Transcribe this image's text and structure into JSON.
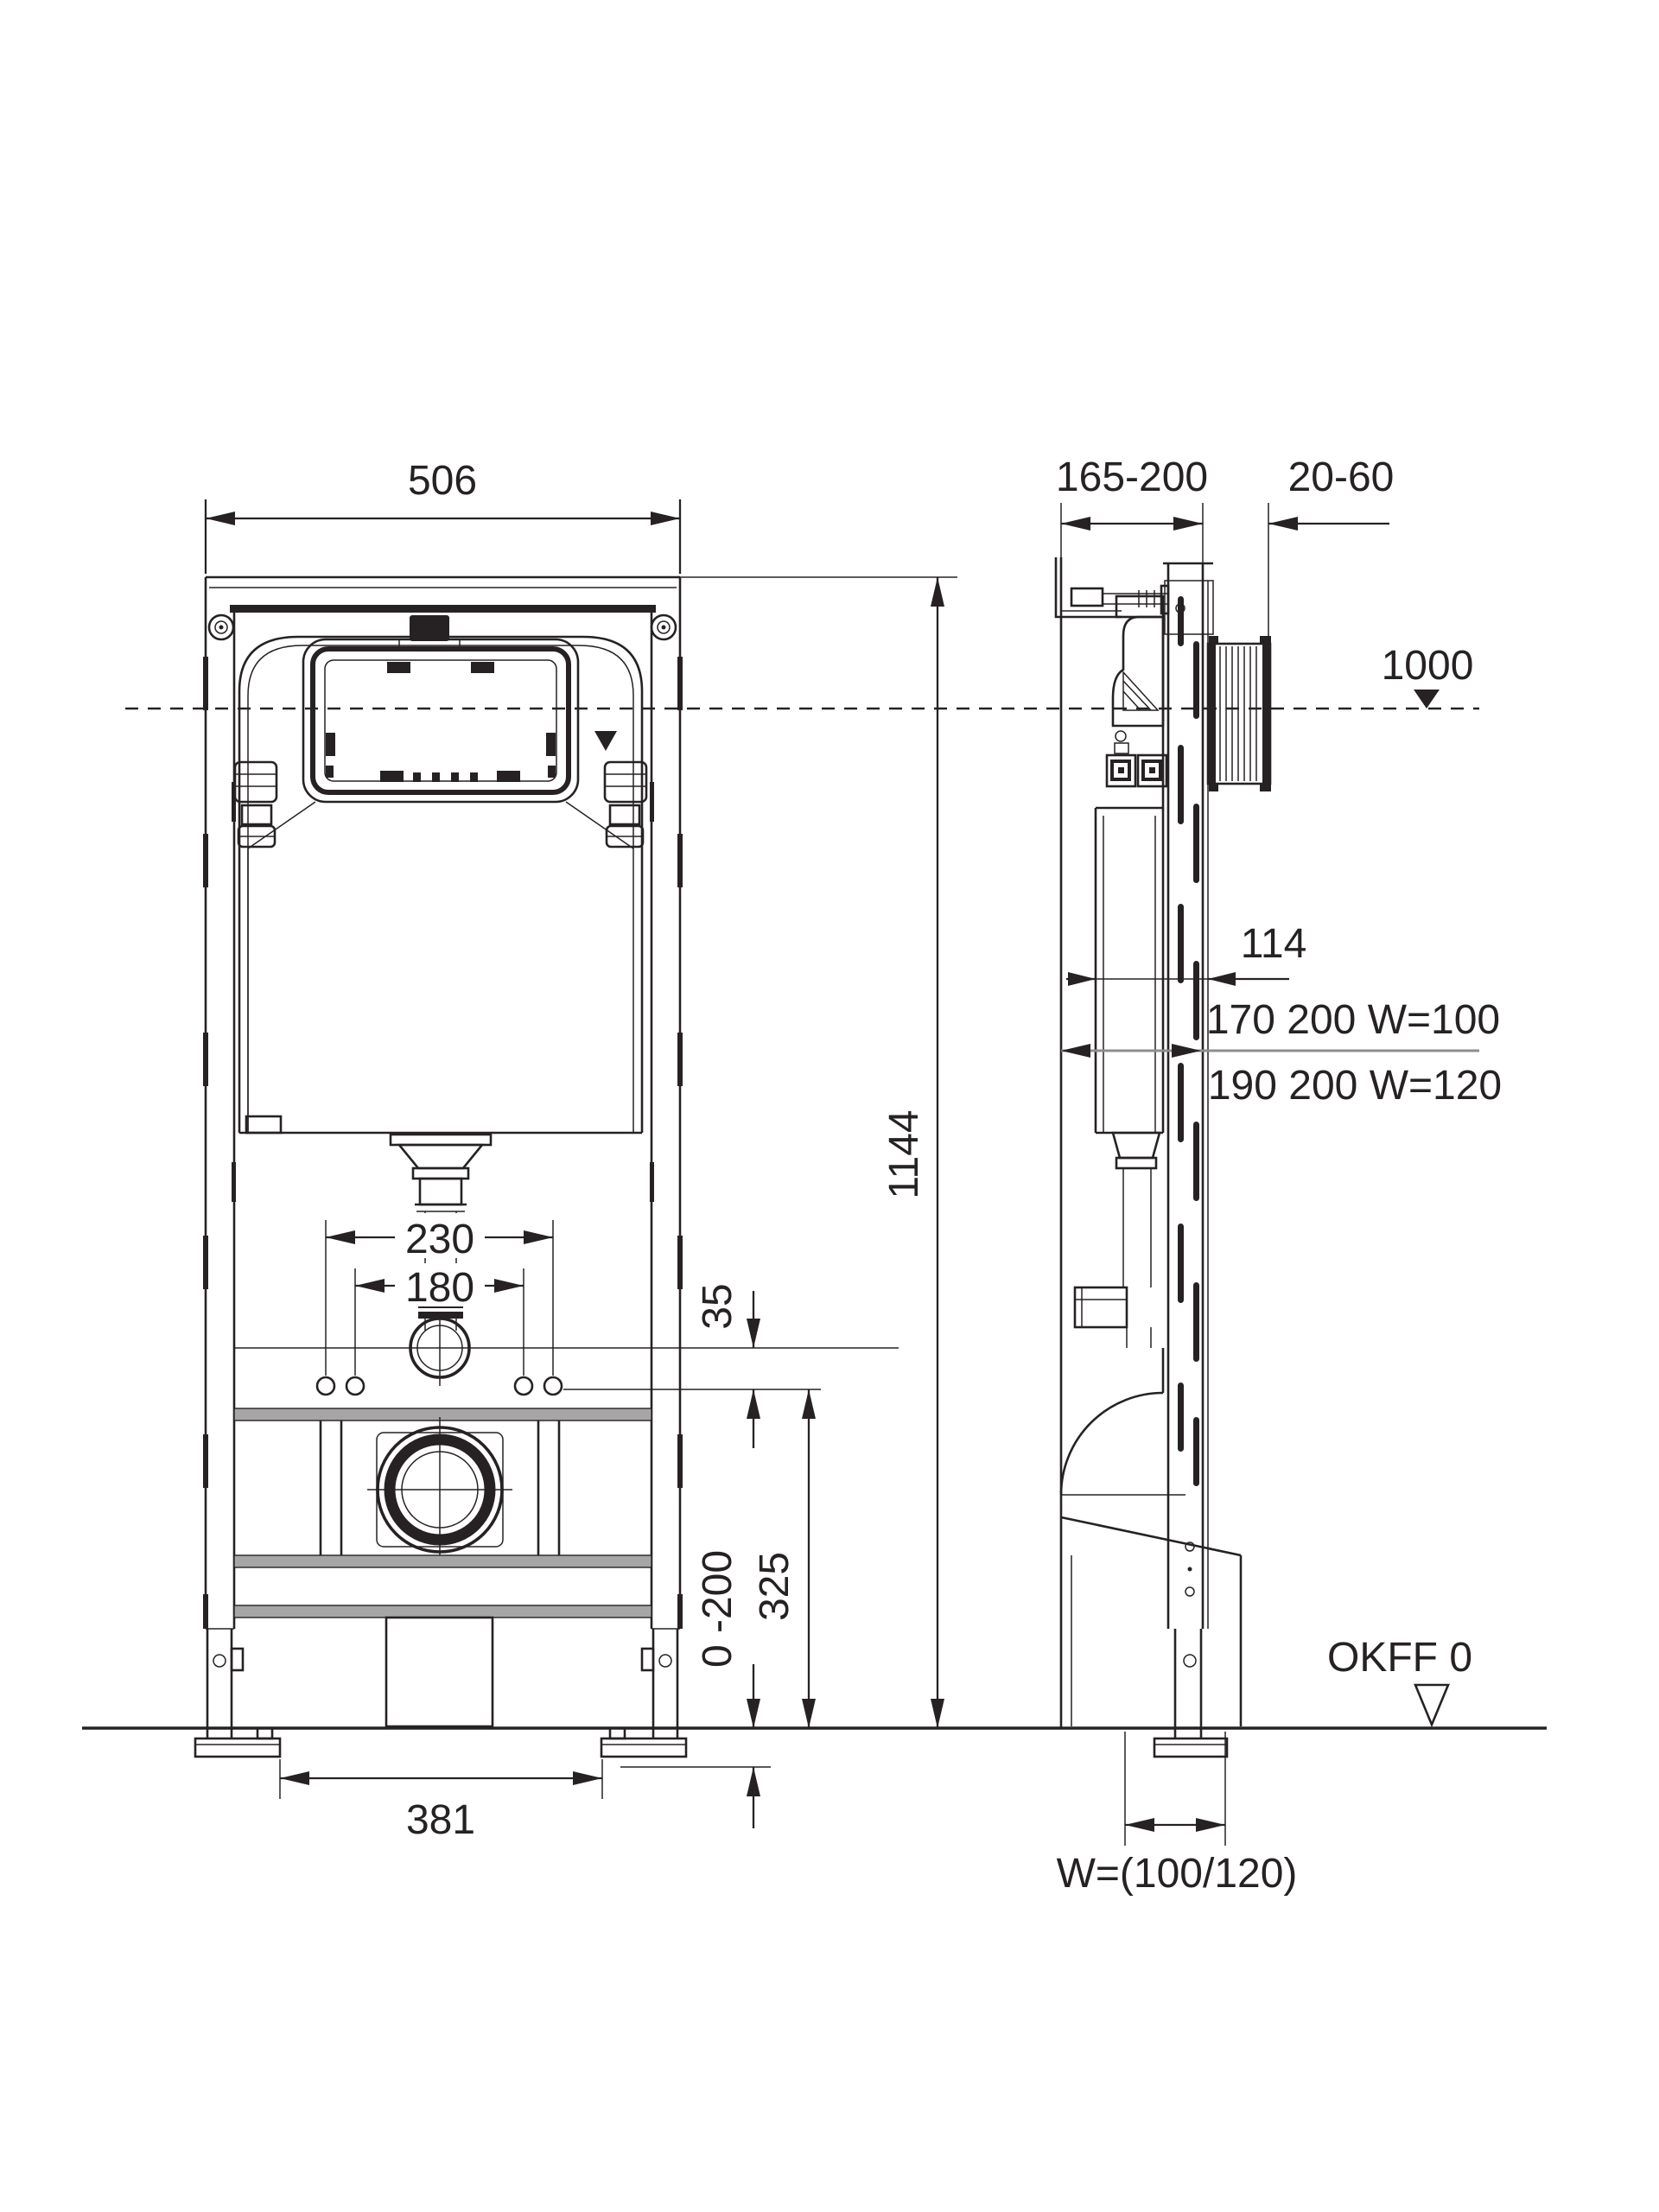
{
  "colors": {
    "line": "#262223",
    "gray_rail": "#a6a6a6",
    "gray_line": "#8d8d8d",
    "background": "#ffffff"
  },
  "front_view": {
    "dims": {
      "overall_width": "506",
      "overall_height": "1144",
      "elbow_ext_spacing": "230",
      "fixing_bolt_spacing": "180",
      "rail_offset": "35",
      "drain_rail_height": "325",
      "floor_adjust_range": "0 -200",
      "feet_spacing": "381"
    }
  },
  "side_view": {
    "dims": {
      "frame_depth_range": "165-200",
      "wall_finish_range": "20-60",
      "actuation_axis_height": "1000",
      "cistern_clearance": "114",
      "supply_option_w100": "170 200 W=100",
      "supply_option_w120": "190 200 W=120",
      "finished_floor_label": "OKFF 0",
      "drain_outlet_width": "W=(100/120)"
    }
  }
}
